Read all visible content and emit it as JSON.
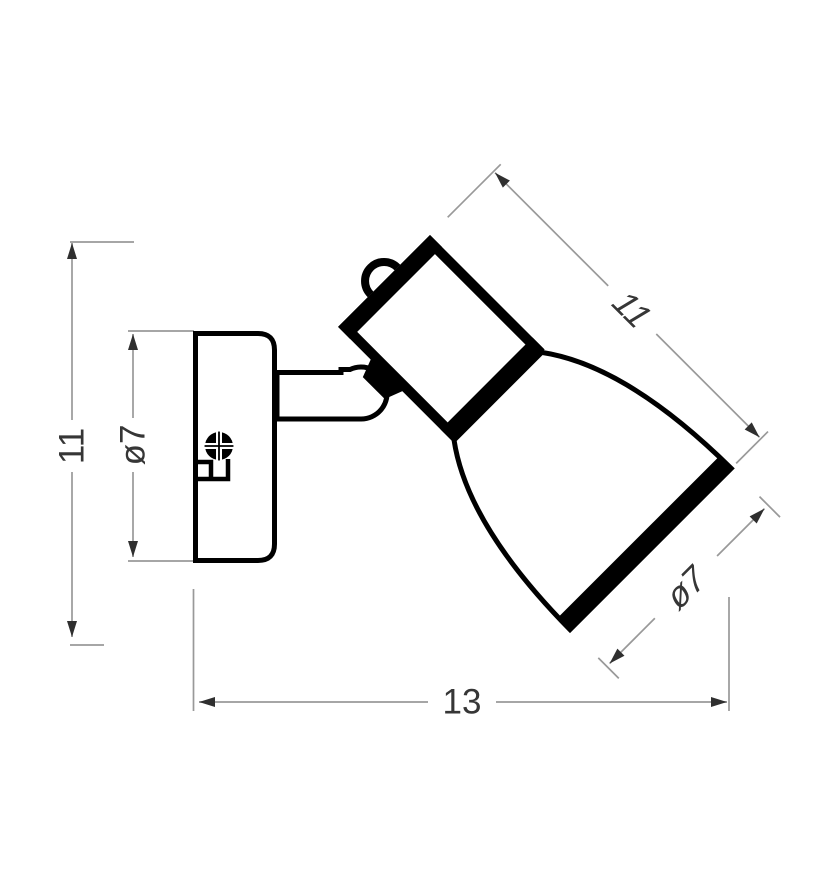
{
  "drawing": {
    "title": "wall-spot-lamp-dimension-drawing",
    "view": "side view technical line drawing",
    "dimensions": {
      "overall_height": "11",
      "backplate_diameter": "ø7",
      "head_length": "11",
      "shade_diameter": "ø7",
      "overall_depth": "13"
    },
    "colors": {
      "background": "#ffffff",
      "outline": "#000000",
      "dimension_line": "#999999",
      "arrowhead": "#2f2f2f",
      "dimension_text": "#363636"
    }
  }
}
